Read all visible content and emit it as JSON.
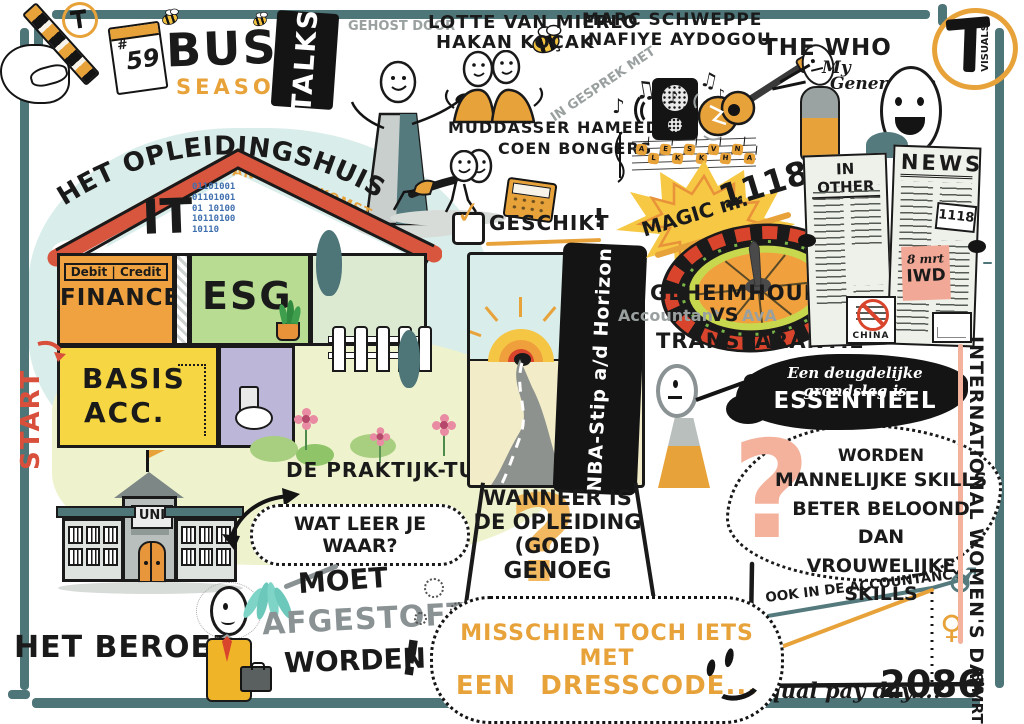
{
  "brand": {
    "hash": "#",
    "number": "59",
    "busy": "BUSY",
    "season": "SEASON",
    "talks": "TALKS"
  },
  "intro": {
    "hosted_by": "GEHOST DOOR",
    "host1": "LOTTE VAN MIERLO",
    "host2": "HAKAN KOÇAK",
    "in_conversation": "IN GESPREK MET",
    "guest_r1": "MARC SCHWEPPE",
    "guest_r2": "NAFIYE AYDOGOU",
    "guest_b1": "MUDDASSER HAMEED",
    "guest_b2": "COEN BONGERS"
  },
  "music": {
    "artist": "THE WHO",
    "song1": "My",
    "song2": "Generation",
    "notes": [
      "♪",
      "♫",
      "♪",
      "♫",
      "♪"
    ],
    "staff_letters": [
      "A",
      "L",
      "E",
      "K",
      "S",
      "K",
      "V",
      "H",
      "N",
      "A"
    ]
  },
  "logo": {
    "word": "VISUALS"
  },
  "house": {
    "title": "HET OPLEIDINGSHUIS",
    "subtitle": "VAN DE TOEKOMST",
    "attic": "IT",
    "binary": "011010010110100101 101001011010010110",
    "debit_credit": "Debit | Credit",
    "finance": "FINANCE",
    "esg": "ESG",
    "basis1": "BASIS",
    "basis2": "ACC.",
    "start": "START"
  },
  "campus": {
    "uni": "UNI",
    "garden": "DE PRAKTIJK-TUIN",
    "question": "WAT LEER JE WAAR?"
  },
  "fit": {
    "label": "GESCHIKT",
    "excl": "!"
  },
  "horizon": {
    "banner": "NBA-Stip a/d Horizon"
  },
  "wanneer": {
    "q": "?",
    "l1": "WANNEER IS",
    "l2": "DE OPLEIDING",
    "l3": "(GOED)",
    "l4": "GENOEG"
  },
  "magic": {
    "label": "MAGIC nr.",
    "number": "1118"
  },
  "debate": {
    "top": "GEHEIMHOUDING",
    "left": "Accountant",
    "vs": "VS",
    "right": "AvA",
    "bottom": "TRANSPARANTIE"
  },
  "grondslag": {
    "l1": "Een deugdelijke grondslag is",
    "l2": "ESSENTIEEL"
  },
  "skills": {
    "q": "?",
    "l1": "WORDEN",
    "l2": "MANNELIJKE SKILLS",
    "l3": "BETER BELOOND DAN",
    "l4": "VROUWELIJKE SKILLS"
  },
  "newspaper": {
    "left": "IN OTHER",
    "right": "NEWS",
    "badge": "1118",
    "sticky_date": "8 mrt",
    "sticky_label": "IWD",
    "stamp": "CHINA"
  },
  "iwd": {
    "title": "INTERNATIONAL WOMEN'S DAY",
    "date": "8 MRT"
  },
  "beroep": {
    "title": "HET BEROEP",
    "moet": "MOET",
    "afgestoft": "AFGESTOFT",
    "worden": "WORDEN",
    "excl": "!"
  },
  "dresscode": {
    "l1": "MISSCHIEN TOCH IETS MET",
    "l2a": "EEN",
    "l2b": "DRESSCODE",
    "dots": "..."
  },
  "colors": {
    "teal": "#4e7578",
    "orange": "#e8a23a",
    "yellow": "#f6d743",
    "red": "#d8553e",
    "salmon": "#f4b29c",
    "green": "#b7dc92"
  },
  "chart_data": {
    "type": "line",
    "title": "OOK IN DE ACCOUNTANCY",
    "annotation_label": "Equal pay day...?",
    "annotation_value": "2086",
    "male_symbol": "♂",
    "female_symbol": "♀",
    "series": [
      {
        "name": "mannen",
        "symbol": "♂",
        "color": "#557a7d",
        "points": [
          [
            20,
            60
          ],
          [
            196,
            30
          ],
          [
            224,
            22
          ]
        ]
      },
      {
        "name": "vrouwen",
        "symbol": "♀",
        "color": "#e8a23a",
        "points": [
          [
            16,
            100
          ],
          [
            196,
            32
          ]
        ]
      }
    ],
    "convergence": {
      "x": 196,
      "y_top": 32,
      "y_axis": 128
    },
    "axes": {
      "style": "hand-drawn L axis, no ticks",
      "x_range": "now → 2086"
    }
  }
}
